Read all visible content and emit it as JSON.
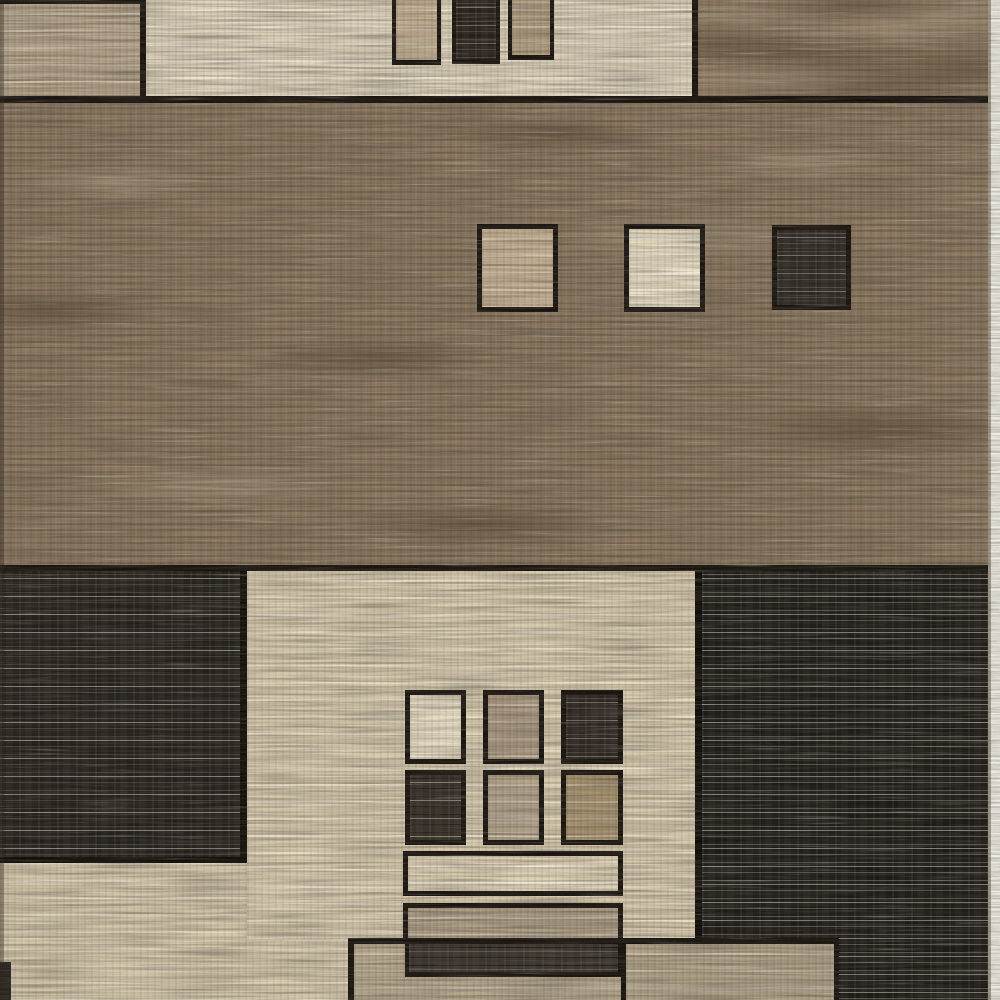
{
  "scene": {
    "description": "Close-up product photo of a modern geometric area rug woven in beige, cream, taupe brown and charcoal, composed of rectangular color blocks, small outlined squares and horizontal bars with black outlines.",
    "type": "area-rug-product-photo",
    "border_color": "#1a140f",
    "palette": {
      "beige": "#d3c6aa",
      "cream": "#e9dfc7",
      "taupe": "#b4a68d",
      "brown": "#8b7961",
      "charcoal": "#231f1b",
      "outline_black": "#18130e",
      "photo_edge_white": "#f0ede5"
    },
    "blocks": [
      {
        "name": "base-beige-field",
        "x": 0,
        "y": 565,
        "w": 1000,
        "h": 435,
        "tex": "stripes",
        "c1": "#d3c6aa",
        "c2": "#c5b79a",
        "c3": "rgba(238,230,211,0.55)"
      },
      {
        "name": "middle-brown-field",
        "x": 0,
        "y": 96,
        "w": 1000,
        "h": 476,
        "tex": "mottle",
        "c1": "#8b7961",
        "c2": "#796751",
        "c3": "rgba(80,64,46,0.55)",
        "c4": "rgba(180,164,139,0.5)"
      },
      {
        "name": "top-cream-panel",
        "x": 140,
        "y": 0,
        "w": 560,
        "h": 97,
        "tex": "stripes",
        "c1": "#dcd2bc",
        "c2": "#cfc3a7",
        "c3": "rgba(245,239,224,0.6)"
      },
      {
        "name": "top-left-striped-block",
        "x": 0,
        "y": 0,
        "w": 146,
        "h": 97,
        "tex": "stripes",
        "c1": "#b6a58d",
        "c2": "#a18f76",
        "c3": "rgba(222,209,184,0.65)",
        "borders": {
          "t": 4,
          "r": 6
        }
      },
      {
        "name": "top-right-brown-block",
        "x": 692,
        "y": 0,
        "w": 308,
        "h": 98,
        "tex": "mottle",
        "c1": "#8e7b64",
        "c2": "#7c6951",
        "c3": "rgba(88,72,52,0.5)",
        "c4": "rgba(174,157,131,0.5)",
        "borders": {
          "l": 6
        }
      },
      {
        "name": "hanging-rect-tan-left",
        "x": 392,
        "y": 0,
        "w": 49,
        "h": 65,
        "tex": "stripes",
        "c1": "#c4b194",
        "c2": "#b5a284",
        "borders": {
          "l": 4,
          "r": 4,
          "b": 5
        }
      },
      {
        "name": "hanging-rect-dark",
        "x": 452,
        "y": 0,
        "w": 48,
        "h": 64,
        "tex": "darkstripes",
        "c1": "#262019",
        "c2": "#464039",
        "c3": "#6d675e",
        "borders": {
          "l": 4,
          "r": 4,
          "b": 5
        }
      },
      {
        "name": "hanging-rect-tan-right",
        "x": 508,
        "y": 0,
        "w": 46,
        "h": 60,
        "tex": "stripes",
        "c1": "#b3a185",
        "c2": "#a28f70",
        "borders": {
          "l": 4,
          "r": 4,
          "b": 5
        }
      },
      {
        "name": "divider-line-top",
        "x": 0,
        "y": 96,
        "w": 1000,
        "h": 7,
        "tex": "solid",
        "c1": "#18130e"
      },
      {
        "name": "middle-square-tan",
        "x": 477,
        "y": 224,
        "w": 81,
        "h": 88,
        "tex": "stripes",
        "c1": "#c6b194",
        "c2": "#b7a285",
        "c3": "rgba(233,221,197,0.5)",
        "borders": {
          "t": 5,
          "r": 5,
          "b": 5,
          "l": 5
        }
      },
      {
        "name": "middle-square-cream",
        "x": 624,
        "y": 224,
        "w": 81,
        "h": 88,
        "tex": "stripes",
        "c1": "#e9dfc7",
        "c2": "#ded2b5",
        "c3": "rgba(250,246,235,0.6)",
        "borders": {
          "t": 5,
          "r": 5,
          "b": 5,
          "l": 5
        }
      },
      {
        "name": "middle-square-dark",
        "x": 772,
        "y": 225,
        "w": 79,
        "h": 85,
        "tex": "darkstripes",
        "c1": "#2b2620",
        "c2": "#4d463e",
        "c3": "#787166",
        "borders": {
          "t": 5,
          "r": 5,
          "b": 5,
          "l": 5
        }
      },
      {
        "name": "divider-line-middle",
        "x": 0,
        "y": 565,
        "w": 1000,
        "h": 8,
        "tex": "solid",
        "c1": "#18130e"
      },
      {
        "name": "bottom-left-dark-block",
        "x": 0,
        "y": 571,
        "w": 247,
        "h": 292,
        "tex": "darkstripes",
        "c1": "#231f1b",
        "c2": "#433d36",
        "c3": "#8b8479",
        "bc": "#120e0a",
        "borders": {
          "r": 7,
          "b": 6
        }
      },
      {
        "name": "lower-beige-panel",
        "x": 247,
        "y": 571,
        "w": 448,
        "h": 369,
        "tex": "stripes",
        "c1": "#d6c9ad",
        "c2": "#c8ba9d",
        "c3": "rgba(240,233,216,0.6)"
      },
      {
        "name": "bottom-right-dark-block",
        "x": 695,
        "y": 571,
        "w": 293,
        "h": 429,
        "tex": "darkstripes",
        "c1": "#1d1a17",
        "c2": "#57534b",
        "c3": "#837e74",
        "bc": "#110d0a",
        "borders": {
          "l": 7
        }
      },
      {
        "name": "grid-square-cream",
        "x": 405,
        "y": 690,
        "w": 61,
        "h": 74,
        "tex": "stripes",
        "c1": "#e5dbc3",
        "c2": "#d9cdb0",
        "borders": {
          "t": 5,
          "r": 5,
          "b": 5,
          "l": 5
        }
      },
      {
        "name": "grid-square-tan",
        "x": 483,
        "y": 690,
        "w": 61,
        "h": 74,
        "tex": "stripes",
        "c1": "#aa9982",
        "c2": "#9b8970",
        "borders": {
          "t": 5,
          "r": 5,
          "b": 5,
          "l": 5
        }
      },
      {
        "name": "grid-square-dark",
        "x": 561,
        "y": 690,
        "w": 62,
        "h": 74,
        "tex": "darkstripes",
        "c1": "#2a241e",
        "c2": "#49423a",
        "c3": "#6f685d",
        "borders": {
          "t": 5,
          "r": 5,
          "b": 5,
          "l": 5
        }
      },
      {
        "name": "grid-square-charcoal",
        "x": 405,
        "y": 770,
        "w": 61,
        "h": 75,
        "tex": "darkstripes",
        "c1": "#332d25",
        "c2": "#201b15",
        "c3": "#8e8779",
        "borders": {
          "t": 5,
          "r": 5,
          "b": 5,
          "l": 5
        }
      },
      {
        "name": "grid-square-tan-2",
        "x": 483,
        "y": 770,
        "w": 61,
        "h": 75,
        "tex": "stripes",
        "c1": "#b3a38b",
        "c2": "#a49278",
        "borders": {
          "t": 5,
          "r": 5,
          "b": 5,
          "l": 5
        }
      },
      {
        "name": "grid-square-khaki",
        "x": 561,
        "y": 770,
        "w": 62,
        "h": 75,
        "tex": "stripes",
        "c1": "#a99471",
        "c2": "#998460",
        "borders": {
          "t": 5,
          "r": 5,
          "b": 5,
          "l": 5
        }
      },
      {
        "name": "bar-cream",
        "x": 403,
        "y": 851,
        "w": 220,
        "h": 45,
        "tex": "stripes",
        "c1": "#ddd2b7",
        "c2": "#d0c3a3",
        "c3": "rgba(247,243,230,0.65)",
        "borders": {
          "t": 5,
          "r": 5,
          "b": 5,
          "l": 5
        }
      },
      {
        "name": "bar-tan",
        "x": 403,
        "y": 903,
        "w": 220,
        "h": 41,
        "tex": "stripes",
        "c1": "#ac9d86",
        "c2": "#9d8d73",
        "borders": {
          "t": 5,
          "r": 5,
          "b": 5,
          "l": 5
        }
      },
      {
        "name": "bottom-taupe-block-left",
        "x": 348,
        "y": 938,
        "w": 273,
        "h": 62,
        "tex": "stripes",
        "c1": "#b4a68d",
        "c2": "#a59678",
        "borders": {
          "l": 6,
          "t": 6
        }
      },
      {
        "name": "bar-dark",
        "x": 405,
        "y": 940,
        "w": 217,
        "h": 37,
        "tex": "darkstripes",
        "c1": "#37322a",
        "c2": "#1f1a14",
        "c3": "#5f584c",
        "borders": {
          "t": 4,
          "r": 4,
          "b": 5,
          "l": 4
        }
      },
      {
        "name": "bottom-taupe-block-right",
        "x": 621,
        "y": 938,
        "w": 218,
        "h": 62,
        "tex": "stripes",
        "c1": "#b0a289",
        "c2": "#a19275",
        "borders": {
          "l": 5,
          "t": 6,
          "r": 5
        }
      },
      {
        "name": "bottom-left-dark-corner",
        "x": 0,
        "y": 962,
        "w": 11,
        "h": 38,
        "tex": "solid",
        "c1": "#282420"
      },
      {
        "name": "left-edge-shade",
        "x": 0,
        "y": 0,
        "w": 4,
        "h": 1000,
        "tex": "solid",
        "c1": "rgba(42,34,24,0.4)"
      },
      {
        "name": "photo-edge-white-strip",
        "x": 988,
        "y": 0,
        "w": 12,
        "h": 1000,
        "tex": "solid",
        "c1": "#f0ede5",
        "bc": "#a39d8e",
        "borders": {
          "l": 3
        }
      }
    ]
  }
}
